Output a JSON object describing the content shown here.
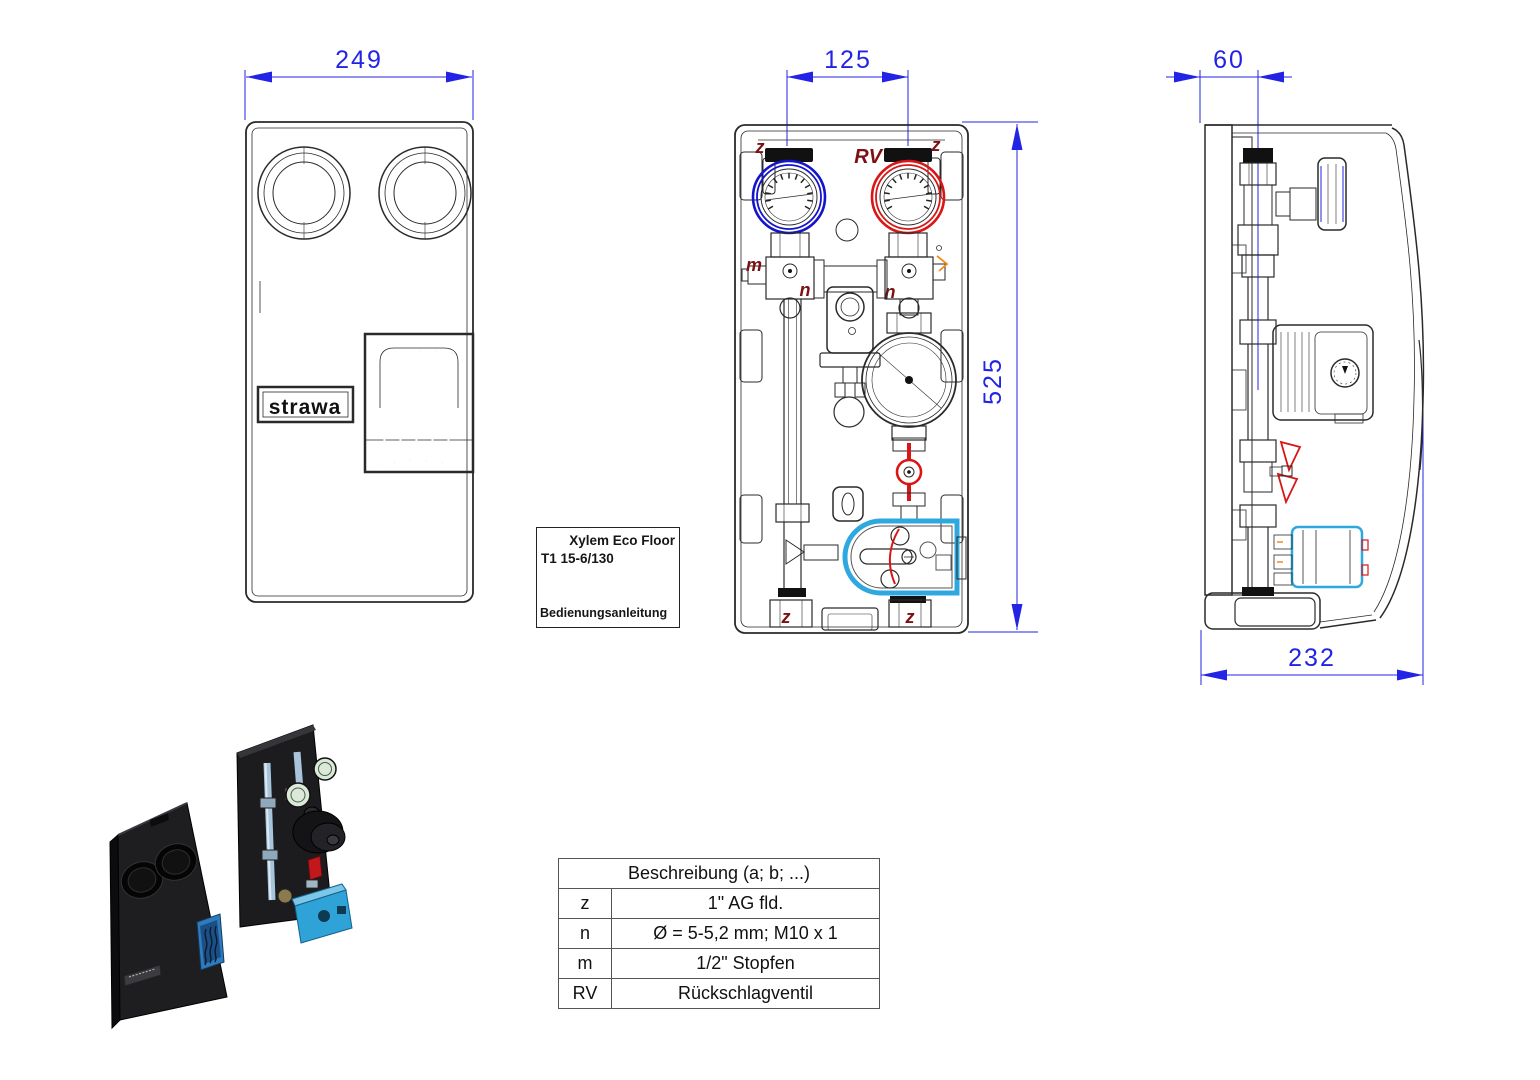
{
  "views": {
    "front_cover": {
      "width_dim": "249",
      "logo_text": "strawa"
    },
    "front_open": {
      "width_dim": "125",
      "height_dim": "525",
      "ports": {
        "z": "z",
        "rv": "RV",
        "m": "m",
        "n": "n"
      }
    },
    "side": {
      "offset_dim": "60",
      "depth_dim": "232"
    }
  },
  "manual_label": {
    "line1": "Xylem Eco Floor",
    "line2": "T1 15-6/130",
    "line3": "Bedienungsanleitung"
  },
  "legend": {
    "header": "Beschreibung (a; b; ...)",
    "rows": [
      {
        "key": "z",
        "desc": "1\" AG fld."
      },
      {
        "key": "n",
        "desc": "Ø = 5-5,2 mm; M10 x 1"
      },
      {
        "key": "m",
        "desc": "1/2\" Stopfen"
      },
      {
        "key": "RV",
        "desc": "Rückschlagventil"
      }
    ]
  },
  "colors": {
    "dimension_blue": "#2323e6",
    "port_label_red": "#7b1113",
    "gauge_ring_blue": "#1414cc",
    "gauge_ring_red": "#d81616",
    "valve_red": "#d81616",
    "mixer_cyan": "#2fa8e0",
    "accent_orange": "#f08c1e",
    "line_black": "#2a2a2a"
  }
}
